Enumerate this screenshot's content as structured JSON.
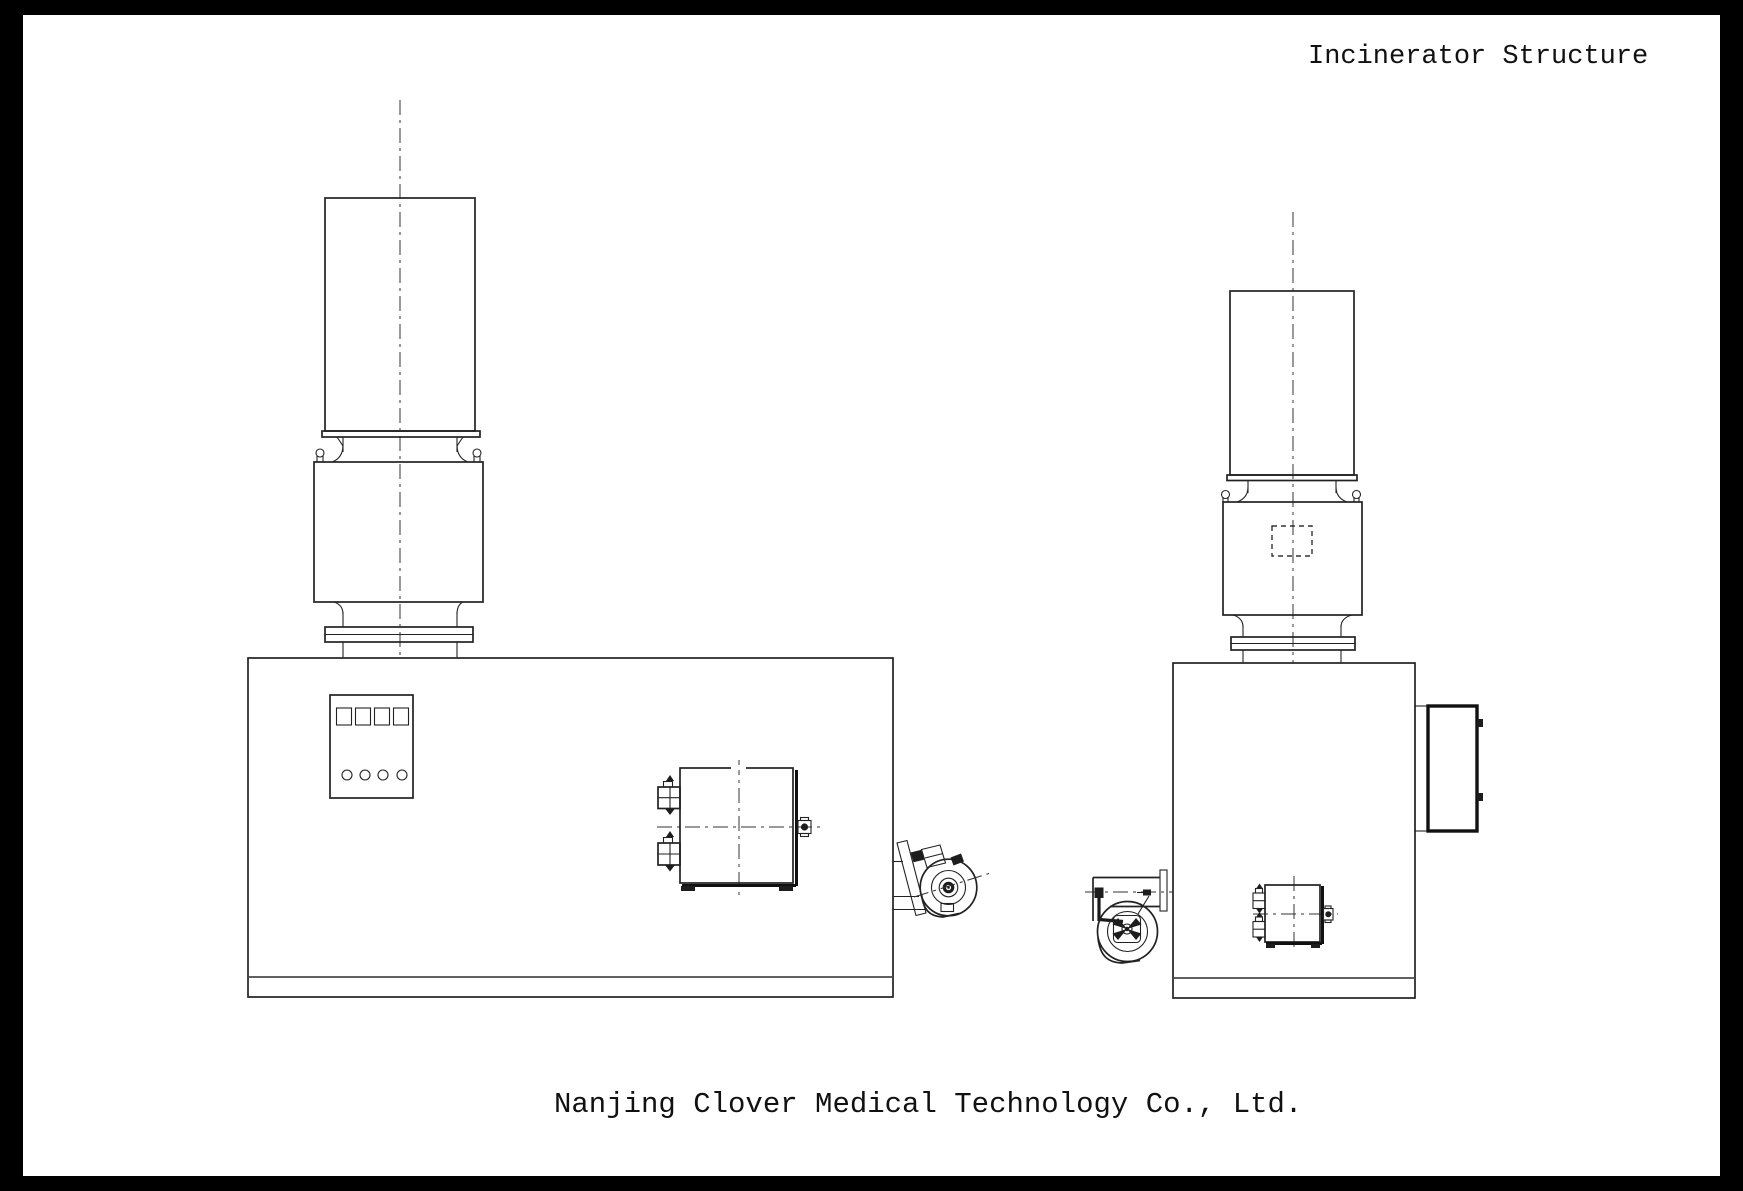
{
  "page": {
    "title": "Incinerator Structure",
    "footer": "Nanjing Clover Medical Technology Co., Ltd."
  },
  "colors": {
    "frame": "#000000",
    "paper": "#ffffff",
    "ink": "#222222",
    "ink_soft": "#4a4a4a"
  }
}
